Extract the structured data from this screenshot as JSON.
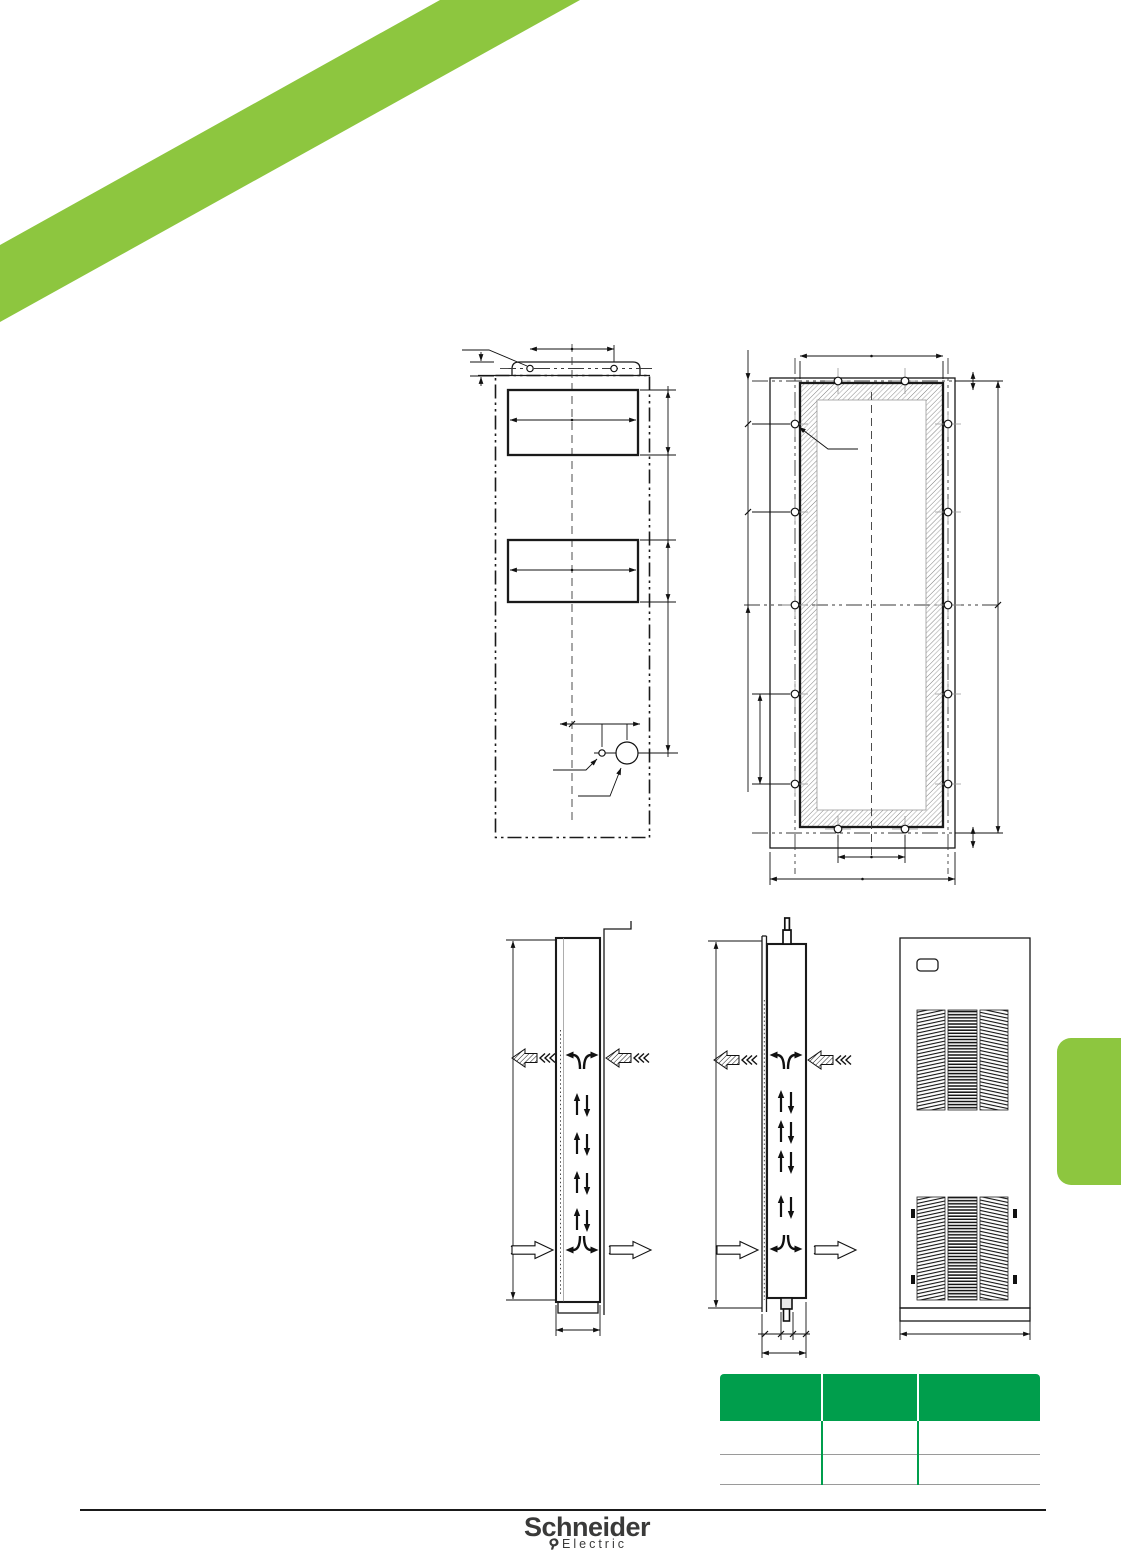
{
  "colors": {
    "accent-green": "#8DC63F",
    "table-green": "#009E4C",
    "line-dark": "#1a1a1a"
  },
  "table": {
    "headers": [
      "",
      "",
      ""
    ],
    "rows": [
      [
        "",
        "",
        ""
      ],
      [
        "",
        "",
        ""
      ]
    ]
  },
  "logo": {
    "brand": "Schneider",
    "sub": "Electric"
  }
}
